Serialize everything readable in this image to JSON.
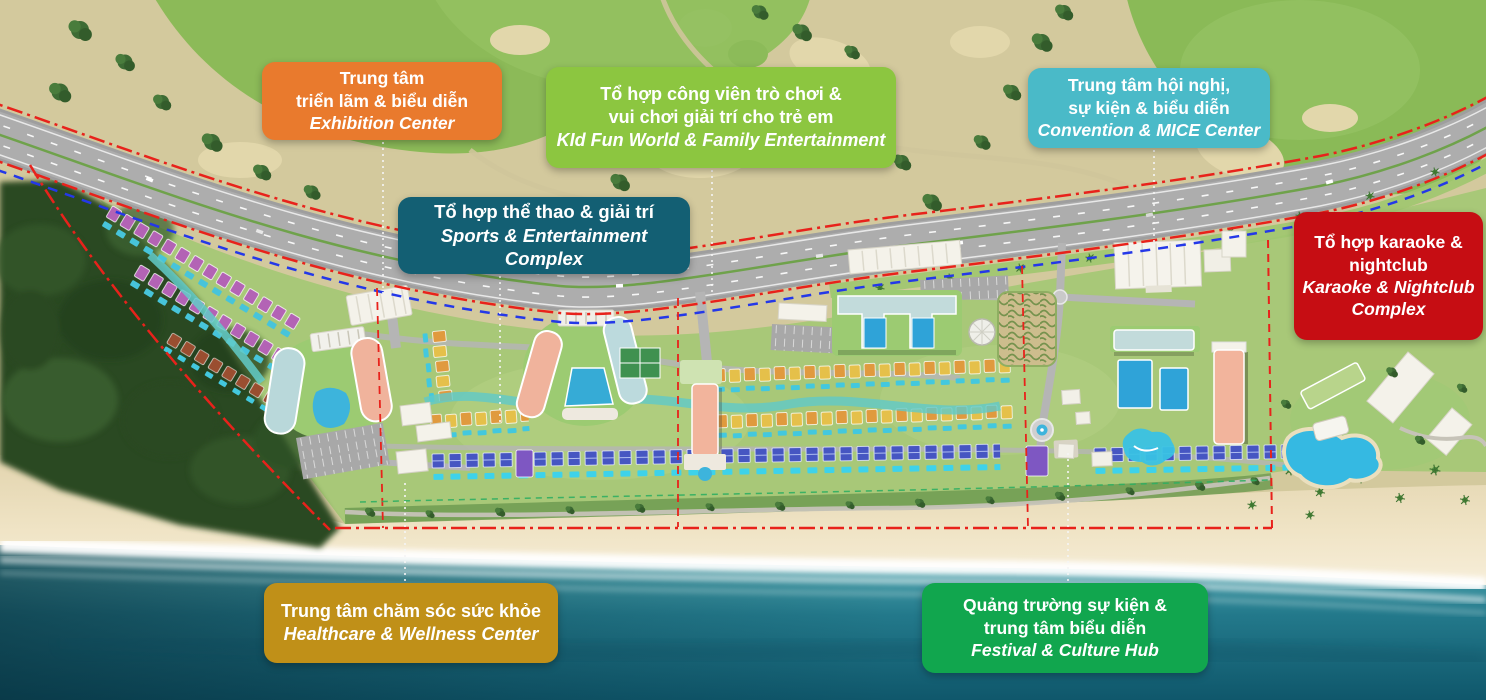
{
  "labels": {
    "exhibition": {
      "vi": [
        "Trung tâm",
        "triển lãm & biểu diễn"
      ],
      "en": [
        "Exhibition Center"
      ],
      "color": "#E97A2D"
    },
    "kidfun": {
      "vi": [
        "Tổ hợp công viên trò chơi &",
        "vui chơi giải trí cho trẻ em"
      ],
      "en": [
        "KId Fun World & Family Entertainment"
      ],
      "color": "#8CC640"
    },
    "convention": {
      "vi": [
        "Trung tâm hội nghị,",
        "sự kiện & biểu diễn"
      ],
      "en": [
        "Convention & MICE Center"
      ],
      "color": "#4ABAC8"
    },
    "sports": {
      "vi": [
        "Tổ hợp thể thao & giải trí"
      ],
      "en": [
        "Sports & Entertainment Complex"
      ],
      "color": "#135F73"
    },
    "karaoke": {
      "vi": [
        "Tổ hợp karaoke &",
        "nightclub"
      ],
      "en": [
        "Karaoke & Nightclub",
        "Complex"
      ],
      "color": "#C60D13"
    },
    "healthcare": {
      "vi": [
        "Trung tâm chăm sóc sức khỏe"
      ],
      "en": [
        "Healthcare & Wellness Center"
      ],
      "color": "#C09018"
    },
    "festival": {
      "vi": [
        "Quảng trường sự kiện &",
        "trung tâm biểu diễn"
      ],
      "en": [
        "Festival & Culture Hub"
      ],
      "color": "#11A64E"
    }
  },
  "map_colors": {
    "boundary_red": "#E8221B",
    "boundary_blue": "#2438E8",
    "sea": "#1F7D8C",
    "sand": "#EFE3C4",
    "forest": "#2C4A24",
    "golf_green": "#8CBA58",
    "road": "#ADADAD"
  }
}
